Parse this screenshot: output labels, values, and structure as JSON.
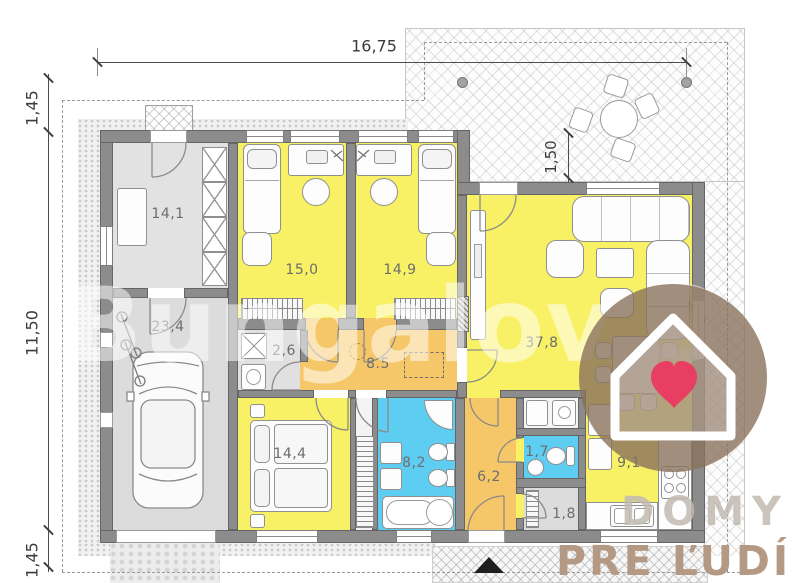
{
  "plan": {
    "watermark": "Bungalov 3",
    "dimensions": {
      "top_width": "16,75",
      "left_overhang_top": "1,45",
      "left_height": "11,50",
      "left_overhang_bottom": "1,45",
      "terrace_depth": "1,50"
    },
    "rooms": [
      {
        "id": "technical-room",
        "area_label": "14,1"
      },
      {
        "id": "garage",
        "area_label": "23,4"
      },
      {
        "id": "bedroom-left",
        "area_label": "15,0"
      },
      {
        "id": "bedroom-middle",
        "area_label": "14,9"
      },
      {
        "id": "laundry",
        "area_label": "2,6"
      },
      {
        "id": "hallway-main",
        "area_label": "8.5"
      },
      {
        "id": "living-room",
        "area_label": "37,8"
      },
      {
        "id": "bedroom-bottom",
        "area_label": "14,4"
      },
      {
        "id": "bathroom",
        "area_label": "8,2"
      },
      {
        "id": "hallway-entry",
        "area_label": "6,2"
      },
      {
        "id": "wc",
        "area_label": "1,7"
      },
      {
        "id": "storage",
        "area_label": "1,8"
      },
      {
        "id": "kitchen",
        "area_label": "9,1"
      }
    ],
    "colors": {
      "room_yellow": "#f8f165",
      "hall_orange": "#f6c768",
      "wet_blue": "#5ecdf2",
      "utility_gray": "#dfdfdf",
      "heart_pink": "#e83e62"
    }
  },
  "branding": {
    "word1": "DOMY",
    "word2": "PRE ĽUDÍ"
  }
}
